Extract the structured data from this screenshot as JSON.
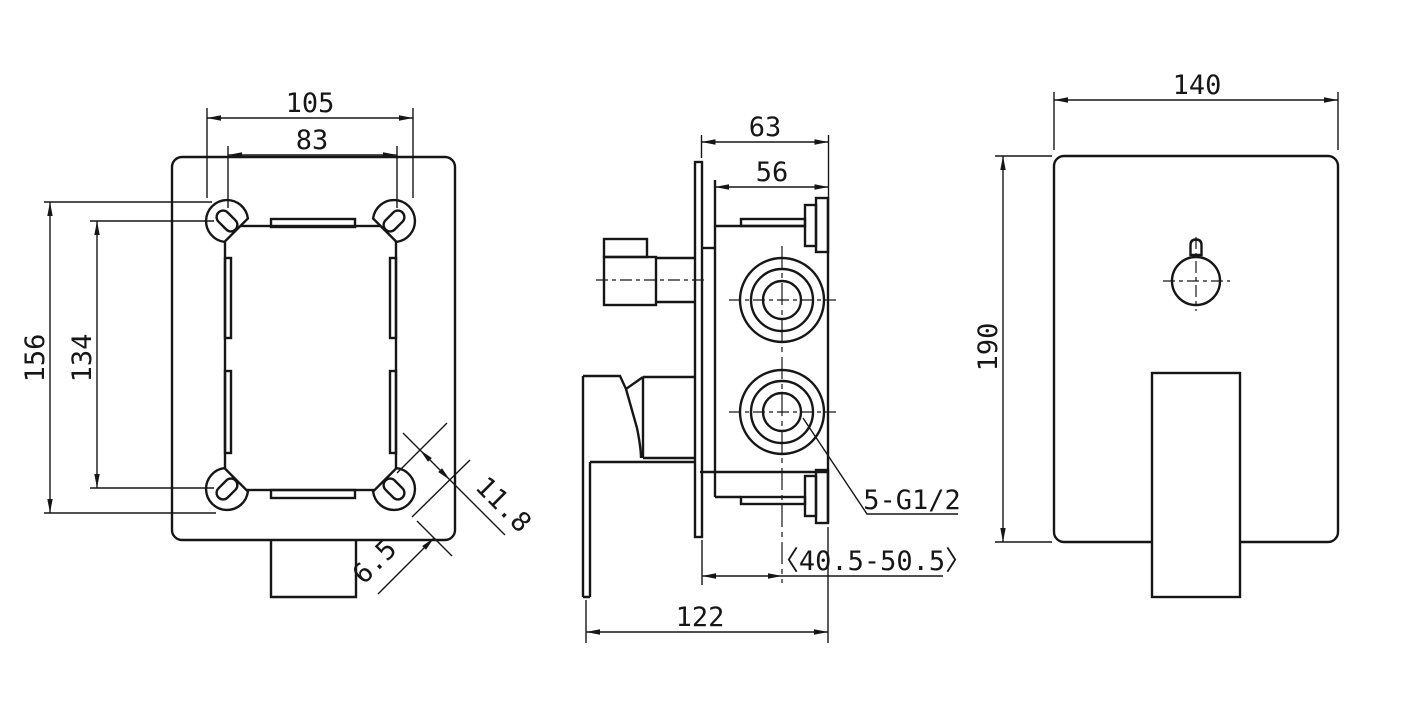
{
  "drawing": {
    "type": "technical-drawing",
    "subject": "concealed shower mixer valve - three orthographic views",
    "background_color": "#ffffff",
    "line_color": "#161616",
    "views": {
      "front_rough_in_box": "front view of rough-in box with 4 corner mounting lugs",
      "side_valve_body": "side view of valve body with lever handle and ports",
      "trim_plate": "front view of trim plate with handle"
    },
    "dims": {
      "d105": "105",
      "d83": "83",
      "d156": "156",
      "d134": "134",
      "d118": "11.8",
      "d65": "6.5",
      "d63": "63",
      "d56": "56",
      "d405": "〈40.5-50.5〉",
      "d122": "122",
      "thread": "5-G1/2",
      "d140": "140",
      "d190": "190"
    }
  }
}
